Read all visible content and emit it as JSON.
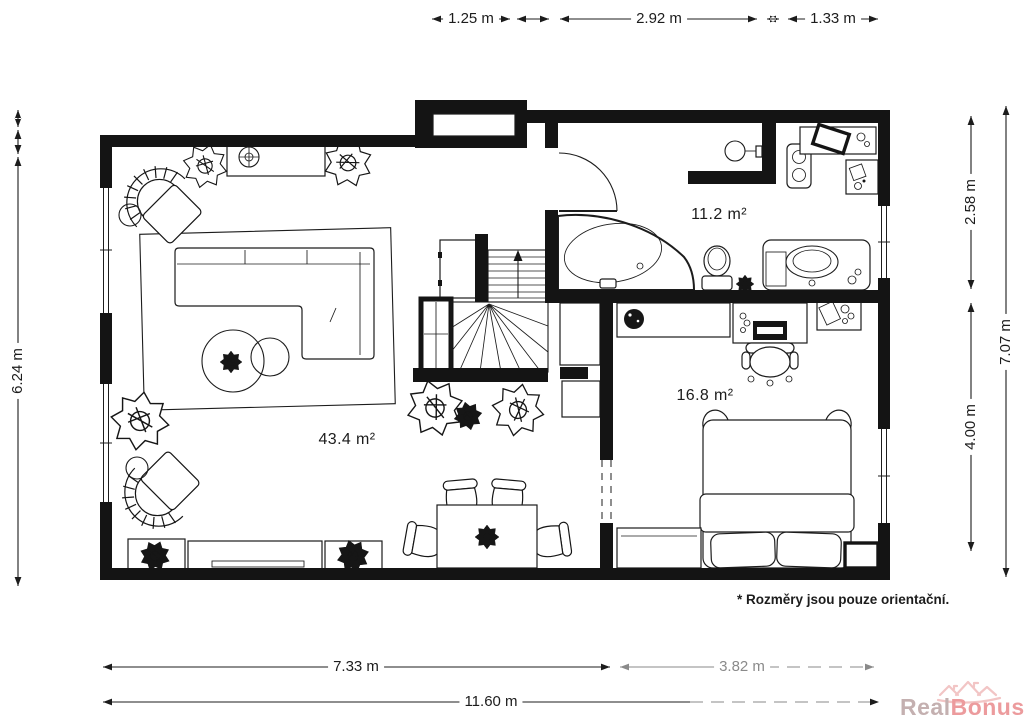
{
  "dimension_labels": {
    "top": [
      "1.25 m",
      "2.92 m",
      "1.33 m"
    ],
    "left": "6.24 m",
    "right": [
      "2.58 m",
      "4.00 m",
      "7.07 m"
    ],
    "bottom": [
      "7.33 m",
      "3.82 m",
      "11.60 m"
    ]
  },
  "room_areas": {
    "living_room": "43.4 m²",
    "bathroom": "11.2 m²",
    "bedroom": "16.8 m²"
  },
  "footnote": "* Rozměry jsou pouze orientační.",
  "watermark": {
    "word1": "Real",
    "word2": "Bonus",
    "tld": ".cz"
  },
  "colors": {
    "wall": "#141414",
    "line": "#1c1c1c",
    "dim_faded": "#8a8a8a",
    "watermark_gray": "#c4b0b0",
    "watermark_pink": "#ec9b9d",
    "watermark_light": "#f2c5c5"
  }
}
